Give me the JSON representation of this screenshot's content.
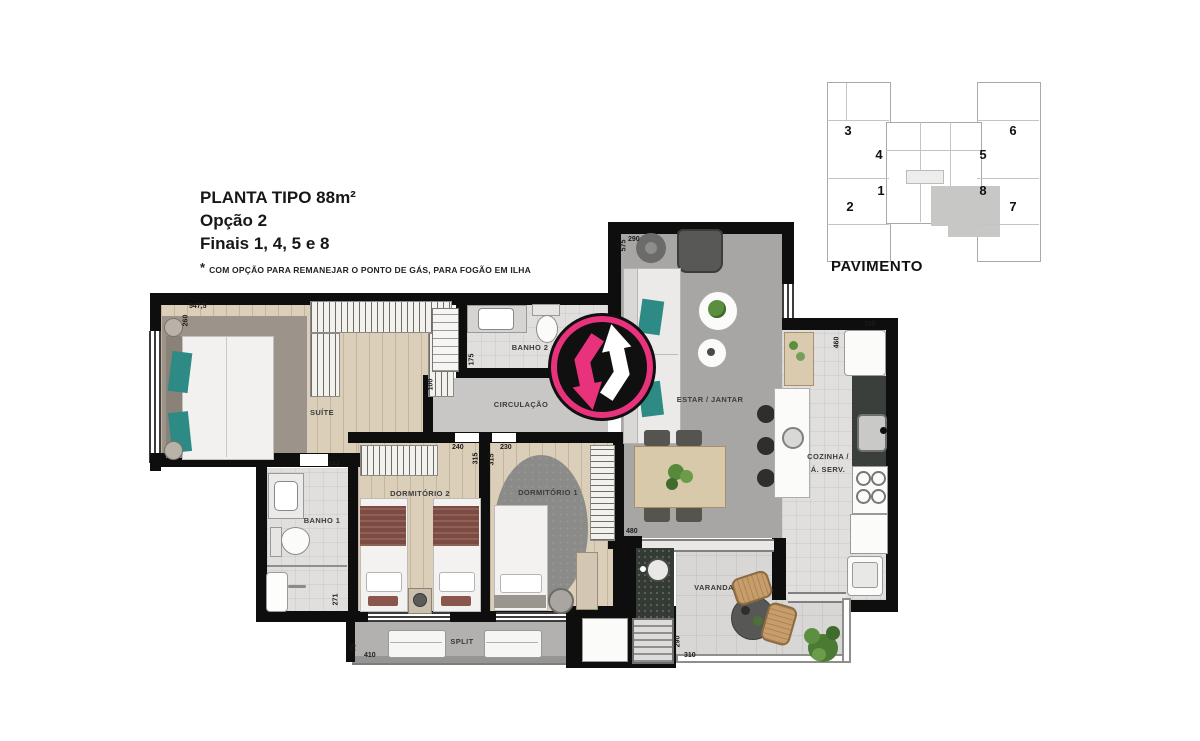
{
  "header": {
    "title": "PLANTA TIPO 88m²",
    "subtitle1": "Opção 2",
    "subtitle2": "Finais 1, 4, 5 e 8",
    "footnote_star": "*",
    "footnote": "COM OPÇÃO PARA REMANEJAR O PONTO DE GÁS, PARA FOGÃO EM ILHA"
  },
  "key_plan": {
    "label": "PAVIMENTO",
    "highlighted_unit": "8",
    "units": [
      "3",
      "4",
      "1",
      "2",
      "6",
      "5",
      "8",
      "7"
    ]
  },
  "plan": {
    "rooms": {
      "suite": "SUÍTE",
      "banho1": "BANHO 1",
      "banho2": "BANHO 2",
      "circulacao": "CIRCULAÇÃO",
      "dorm2": "DORMITÓRIO 2",
      "dorm1": "DORMITÓRIO 1",
      "estar": "ESTAR / JANTAR",
      "cozinha_l1": "COZINHA /",
      "cozinha_l2": "Á. SERV.",
      "varanda": "VARANDA",
      "split": "SPLIT"
    },
    "dims": {
      "suite_width": "547,5",
      "suite_height": "260",
      "banho1_width": "143",
      "banho1_height": "271",
      "dorm2_width": "240",
      "dorm2_height": "315",
      "dorm1_width": "230",
      "dorm1_height": "315",
      "circ_height": "100",
      "banho2_height": "175",
      "estar_width": "290",
      "estar_height": "575",
      "cozinha_width": "165",
      "cozinha_height": "460",
      "estar_bottom": "480",
      "varanda_height": "290",
      "varanda_width": "310",
      "split_width": "410",
      "split_height": "75"
    }
  },
  "watermark": {
    "ring_color": "#e9327c",
    "arrow_pink": "#e9327c",
    "arrow_white": "#ffffff",
    "bg": "#101010"
  }
}
